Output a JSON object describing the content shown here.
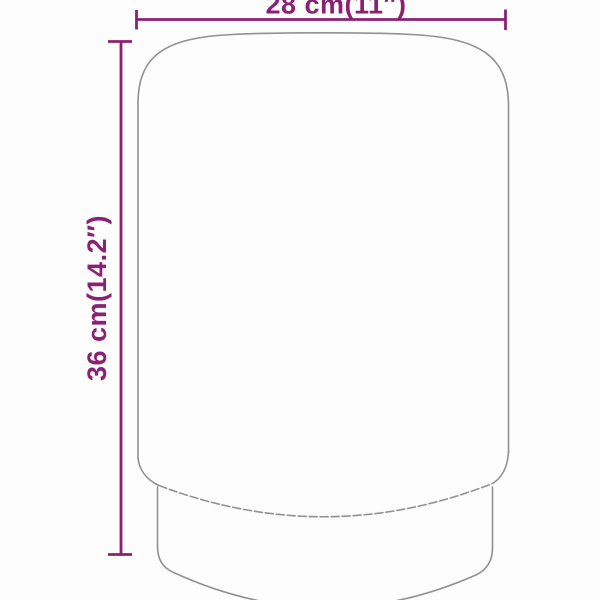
{
  "colors": {
    "accent": "#8a2173",
    "outline": "#919191",
    "background": "#fdfdfd"
  },
  "diagram": {
    "width_label": "28 cm(11″)",
    "height_label": "36 cm(14.2″)"
  }
}
